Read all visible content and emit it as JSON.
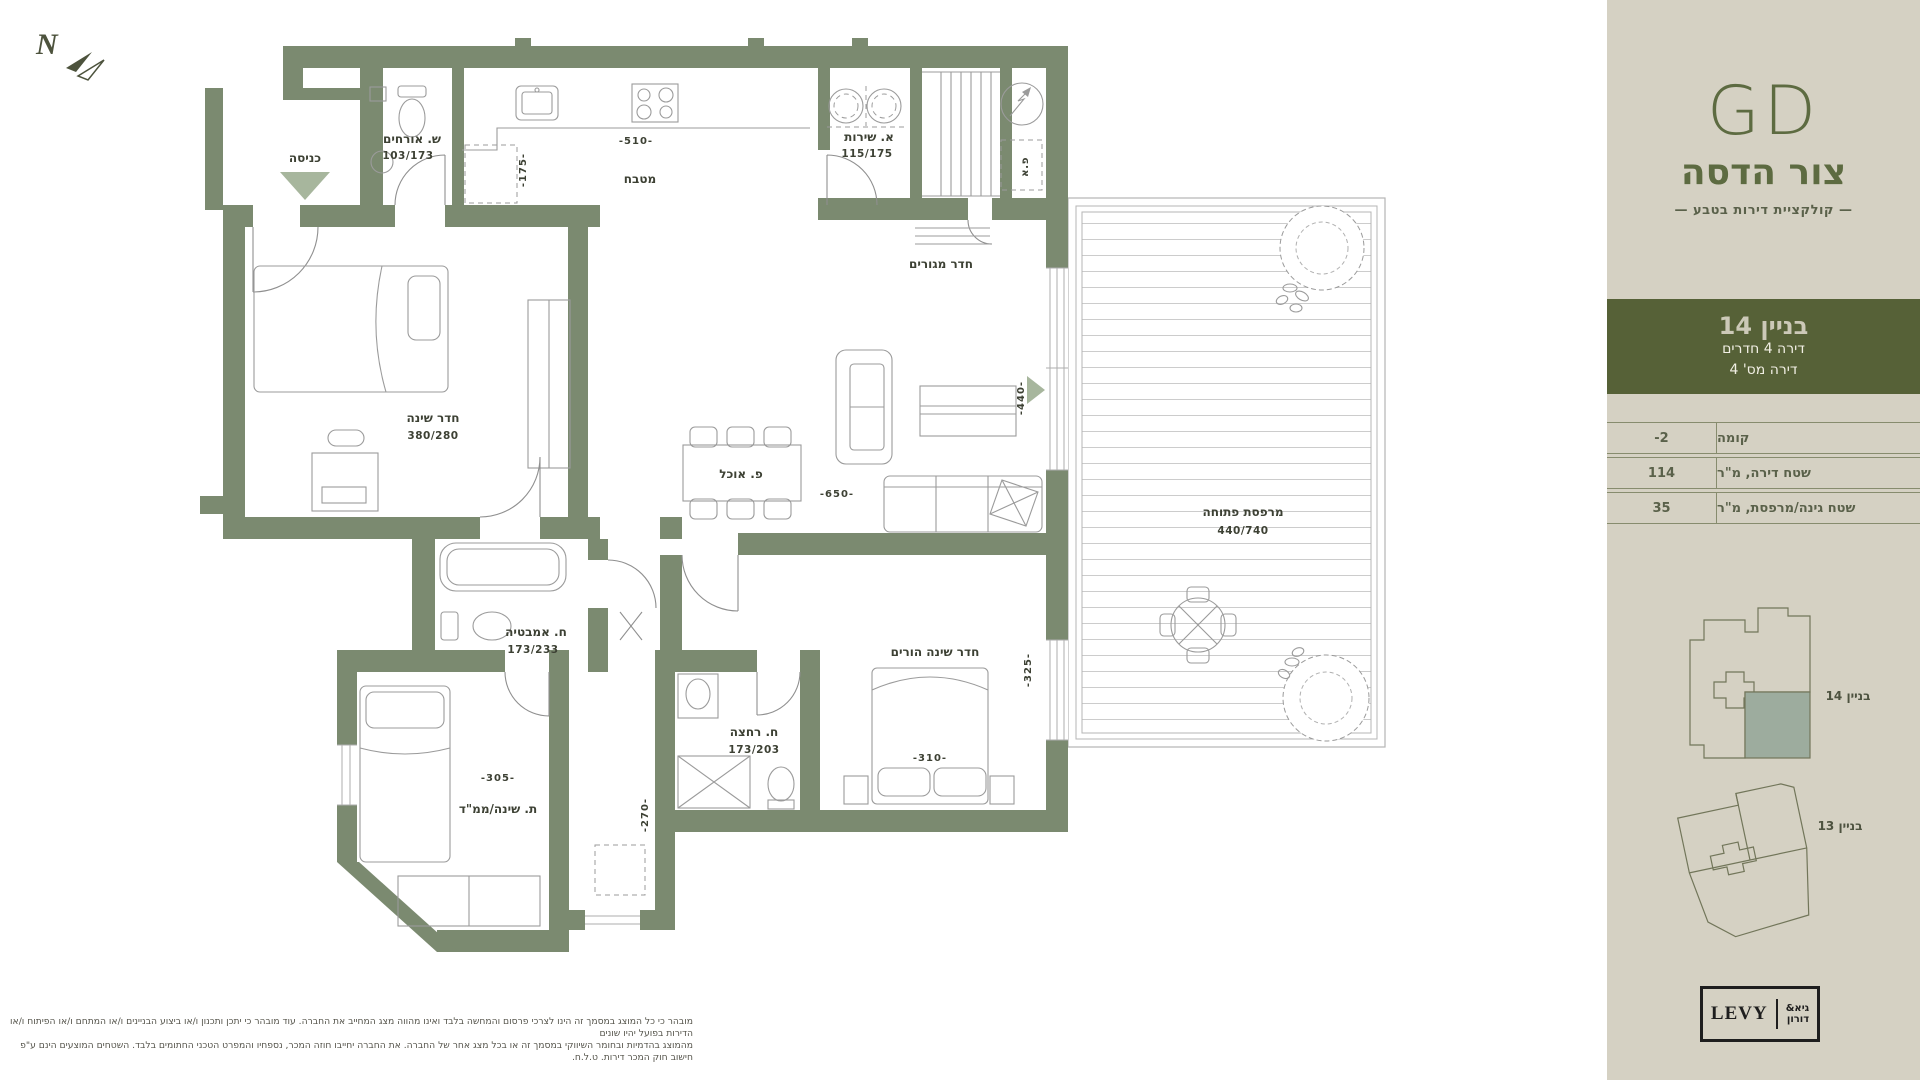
{
  "compass": {
    "letter": "N"
  },
  "plan": {
    "labels": {
      "entrance": "כניסה",
      "guest_wc": "ש. אורחים",
      "guest_wc_dims": "103/173",
      "kitchen": "מטבח",
      "service": "א. שירות",
      "service_dims": "115/175",
      "living": "חדר מגורים",
      "bedroom": "חדר שינה",
      "bedroom_dims": "380/280",
      "dining": "פ. אוכל",
      "balcony": "מרפסת פתוחה",
      "balcony_dims": "440/740",
      "bath": "ח. אמבטיה",
      "bath_dims": "173/233",
      "shower": "ח. רחצה",
      "shower_dims": "173/203",
      "parents": "חדר שינה הורים",
      "saferoom": "ת. שינה/ממ\"ד",
      "elec": "פ.א"
    },
    "dims": {
      "kitchen_w": "-510-",
      "fridge": "-175-",
      "living_door": "-440-",
      "living_w": "-650-",
      "parents_w": "-310-",
      "parents_win": "-325-",
      "saferoom_w": "-305-",
      "saferoom_win": "-270-"
    }
  },
  "sidebar": {
    "logo": {
      "gd": "GD",
      "name": "צור הדסה",
      "tagline": "— קולקציית דירות בטבע —"
    },
    "unit_band": {
      "building": "בניין 14",
      "line2": "דירה 4 חדרים",
      "line3": "דירה מס' 4"
    },
    "table": {
      "rows": [
        {
          "label": "קומה",
          "value": "-2"
        },
        {
          "label": "שטח דירה, מ\"ר",
          "value": "114"
        },
        {
          "label": "שטח גינה/מרפסת, מ\"ר",
          "value": "35"
        }
      ]
    },
    "siteplan": {
      "building14": "בניין 14",
      "building13": "בניין 13"
    },
    "logo_box": {
      "levy": "LEVY",
      "partner_line1": "גיא&",
      "partner_line2": "דורון"
    }
  },
  "disclaimer": {
    "line1": "מובהר כי כל המוצג במסמך זה הינו לצרכי פרסום והמחשה בלבד ואינו מהווה מצג המחייב את החברה. עוד מובהר כי יתכן ותכנון ו/או ביצוע הבניינים ו/או המתחם ו/או הפיתוח ו/או הדירות בפועל יהיו שונים",
    "line2": "מהמוצג בהדמיות ובחומר השיווקי במסמך זה או בכל מצג אחר של החברה. את החברה יחייבו חוזה המכר, נספחיו והמפרט הטכני החתומים בלבד. השטחים המוצעים הינם ע\"פ חישוב חוק המכר דירות. ט.ל.ח."
  }
}
